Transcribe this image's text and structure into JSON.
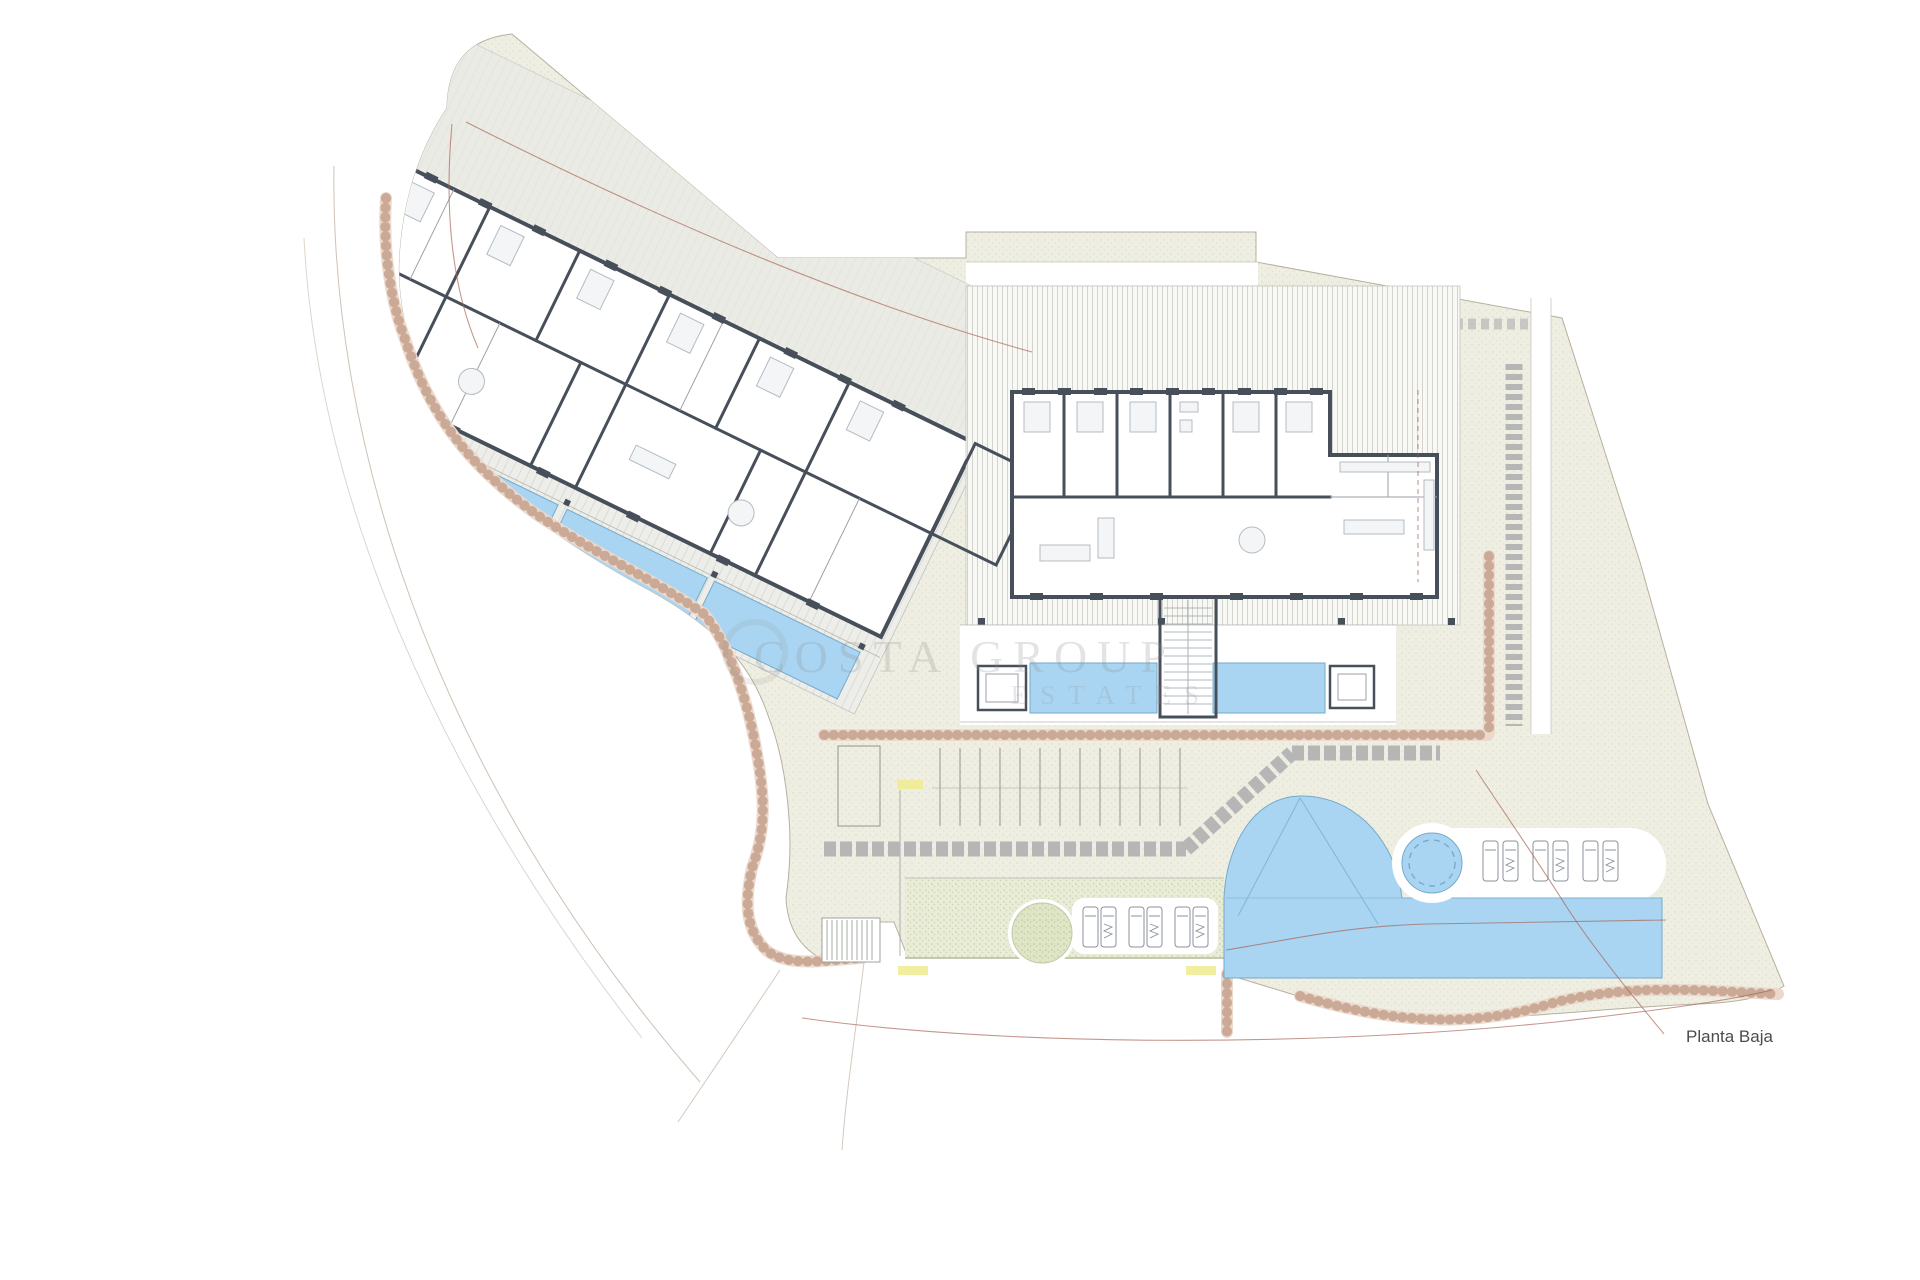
{
  "floor_label": "Planta Baja",
  "watermark": {
    "line1": "COSTA GROUP",
    "line2": "ESTATES"
  },
  "elevation_markers": {
    "count": 3,
    "note": "illegible small yellow elevation labels"
  },
  "colors": {
    "site-beige": "#efeee3",
    "deck-bg": "#f8f8f4",
    "wall-dark": "#47505a",
    "pool-blue": "#a9d5f2",
    "pool-edge": "#74aacb",
    "stone": "#bf9a84",
    "stone-light": "#ecd9cc",
    "boundary-red": "#a4604e",
    "lawn-green": "#e9ecd8",
    "tree-green": "#dfe6c8",
    "marker-yellow": "#efeb8e",
    "path-gray": "#b6b6b6",
    "label-gray": "#4c4c4c",
    "watermark-gray": "#8f8f8f"
  }
}
